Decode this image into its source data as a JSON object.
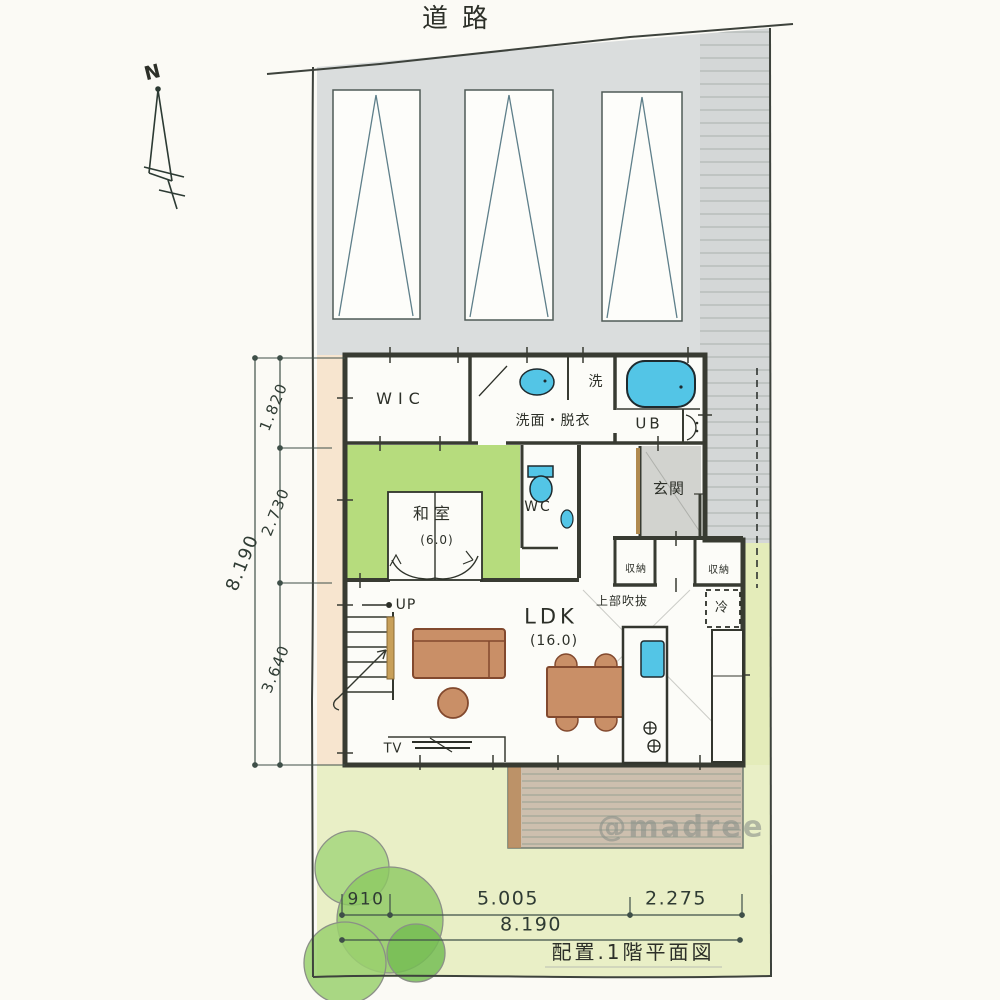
{
  "meta": {
    "road_label": "道路",
    "north_label": "N",
    "caption": "配置.1階平面図",
    "watermark": "@madree"
  },
  "rooms": {
    "wic": "WIC",
    "senmen_datsui": "洗面・脱衣",
    "laundry": "洗",
    "unit_bath": "UB",
    "washitsu": "和室",
    "washitsu_size": "(6.0)",
    "wc": "WC",
    "genkan": "玄関",
    "storage_a": "収納",
    "storage_b": "収納",
    "fridge": "冷",
    "void_above": "上部吹抜",
    "ldk": "LDK",
    "ldk_size": "(16.0)",
    "stairs_up": "UP",
    "tv": "TV"
  },
  "dimensions": {
    "left_total": "8.190",
    "left_segments": [
      "1.820",
      "2.730",
      "3.640"
    ],
    "bottom_segments": [
      "910",
      "5.005",
      "2.275"
    ],
    "bottom_total": "8.190"
  },
  "colors": {
    "ink": "#2c2f28",
    "wall": "#383b32",
    "tatami_green": "#b6dc7d",
    "water_blue": "#53c5e6",
    "furniture_brown": "#c98f67",
    "parking_gray": "#dadddd",
    "approach_gray": "#d4d7d7",
    "genkan_gray": "#d2d3cf",
    "lawn_green": "#e9efc6",
    "soil_orange": "#f7e5cf",
    "deck_tan": "#cdbfae",
    "tree_green": "#8cc862"
  }
}
